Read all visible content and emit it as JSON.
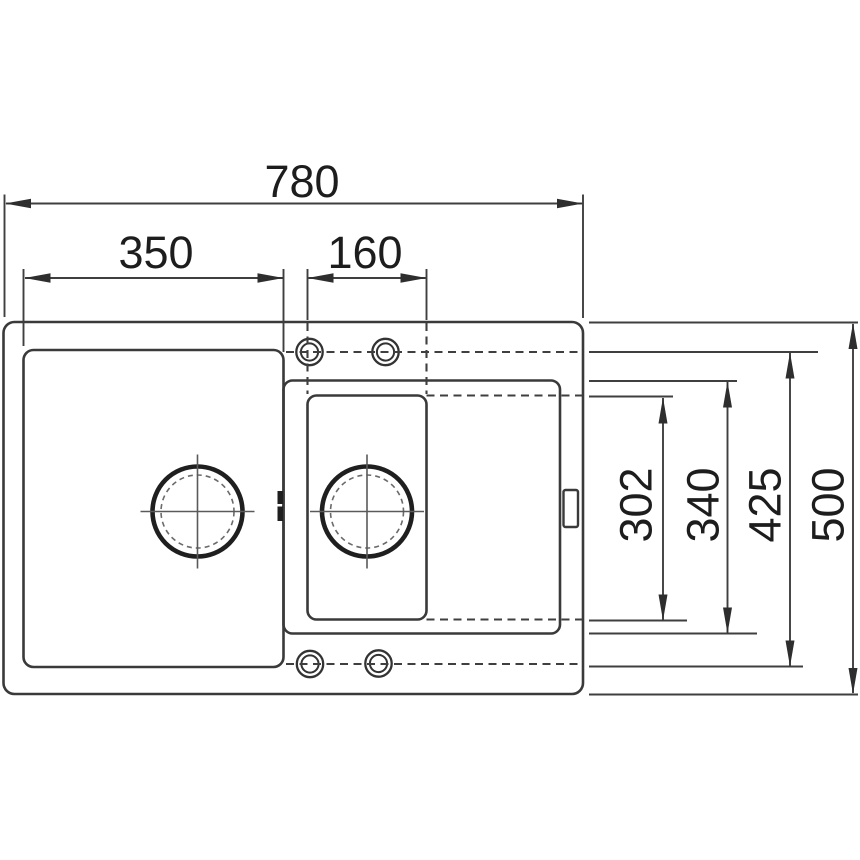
{
  "drawing": {
    "title": "Inset sink top-view dimension drawing",
    "dims": {
      "overall_width": "780",
      "main_bowl_width": "350",
      "half_bowl_width": "160",
      "half_bowl_length": "302",
      "drainer_length": "340",
      "bowl_length": "425",
      "overall_depth": "500"
    },
    "colors": {
      "line": "#3a3a3a",
      "text": "#1d1d1d",
      "background": "#ffffff",
      "drain": "#1f1f1f"
    }
  }
}
